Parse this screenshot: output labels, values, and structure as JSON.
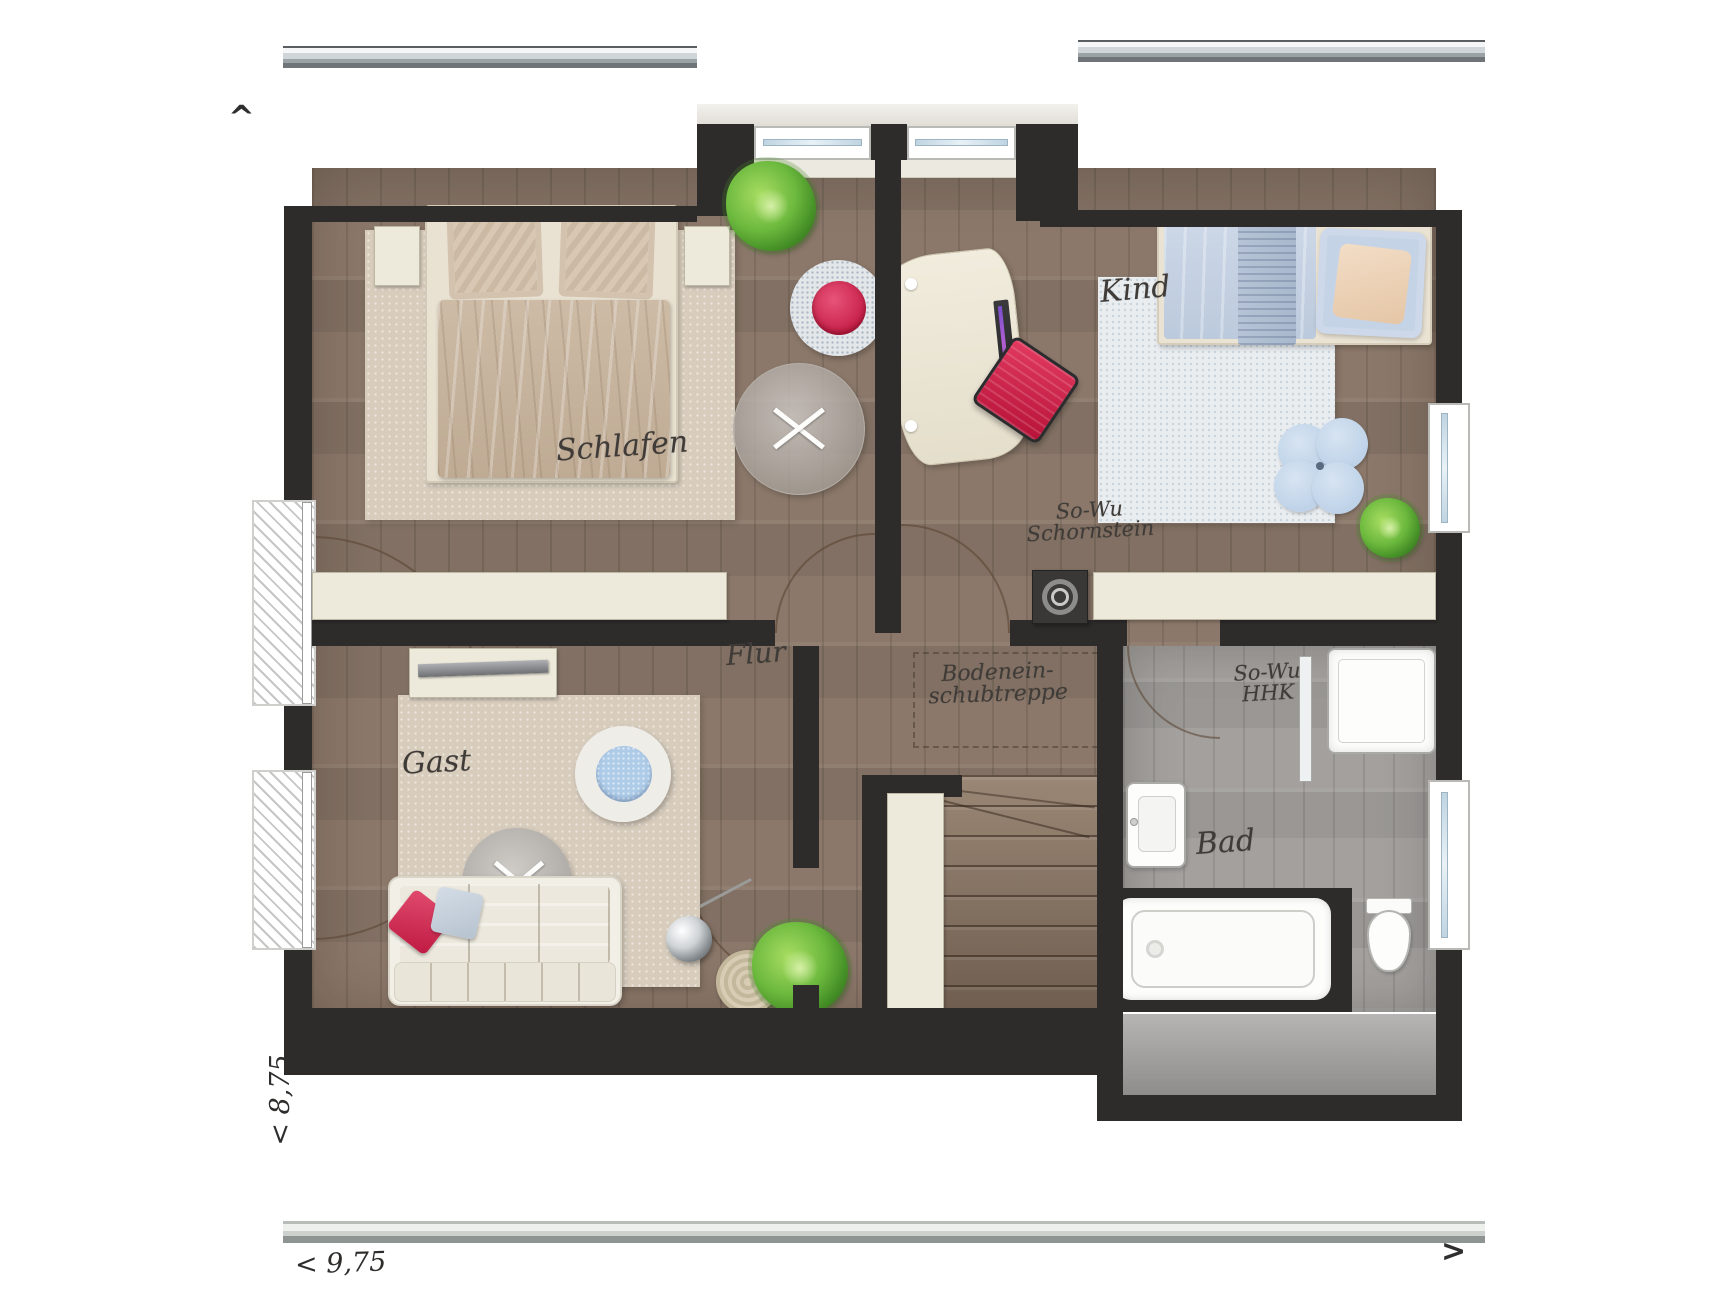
{
  "title": "Dachgeschoss Grundriss (floor plan, upper storey)",
  "rooms": {
    "schlafen": {
      "label": "Schlafen"
    },
    "kind": {
      "label": "Kind"
    },
    "gast": {
      "label": "Gast"
    },
    "flur": {
      "label": "Flur"
    },
    "bad": {
      "label": "Bad"
    }
  },
  "annotations": {
    "chimney": "So-Wu\nSchornstein",
    "hhk": "So-Wu\nHHK",
    "attic_stairs": "Bodenein-\nschubtreppe"
  },
  "dimensions": {
    "left_vertical": "< 8,75",
    "bottom_horizontal": "< 9,75"
  },
  "arrows": {
    "top_left": "^",
    "bottom_right": ">"
  },
  "colors": {
    "wall": "#2e2c2b",
    "floor": "#8b786a",
    "bathfloor": "#a3a09d",
    "roof": "#4a4745",
    "cream": "#edе9db",
    "cream_safe": "#ede9db",
    "rug_beige": "#d8cdbd",
    "rug_blue_white": "#e9edf0",
    "accent_red": "#d6224c",
    "bed_blue": "#c7d3e4",
    "pillow_peach": "#ecd4ba",
    "ink": "#3f3b38"
  },
  "furniture": {
    "schlafen": [
      "double-bed",
      "pillows",
      "duvet",
      "nightstand-left",
      "nightstand-right",
      "rug",
      "sideboard"
    ],
    "anteroom": [
      "fern-plant",
      "round-chair-red-cushion",
      "glass-table"
    ],
    "kind": [
      "single-bed",
      "peach-pillow",
      "rug",
      "desk",
      "monitor",
      "keyboard",
      "red-office-chair",
      "flower-cushion",
      "plant",
      "sideboard"
    ],
    "gast": [
      "sideboard-with-rail",
      "round-chair-blue-cushion",
      "round-side-table",
      "floor-lamp",
      "woven-table",
      "fern-plant",
      "sofa",
      "red-pillow",
      "gray-pillow",
      "rug"
    ],
    "bad": [
      "shower-tray",
      "shower-glass-door",
      "washbasin",
      "bathtub",
      "toilet"
    ],
    "flur": [
      "attic-hatch-dashed",
      "chimney-block",
      "staircase",
      "tall-cabinet"
    ]
  }
}
